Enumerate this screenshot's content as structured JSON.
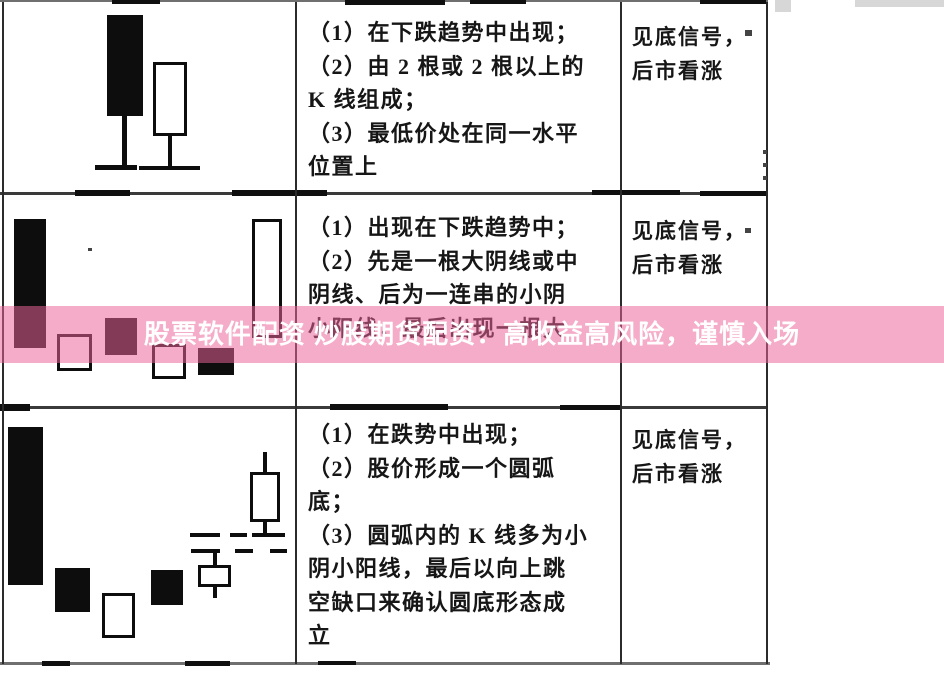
{
  "banner": {
    "text": "股票软件配资 炒股期货配资：高收益高风险，谨慎入场",
    "overlay_color": "#ec6297",
    "text_color": "#ffffff"
  },
  "table": {
    "rows": [
      {
        "description_lines": [
          "（1）在下跌趋势中出现；",
          "（2）由 2 根或 2 根以上的",
          "K 线组成；",
          "（3）最低价处在同一水平",
          "位置上"
        ],
        "signal_lines": [
          "见底信号，",
          "后市看涨"
        ]
      },
      {
        "description_lines": [
          "（1）出现在下跌趋势中；",
          "（2）先是一根大阴线或中",
          "阴线、后为一连串的小阴",
          "小阳线，最后出现一根大"
        ],
        "signal_lines": [
          "见底信号，",
          "后市看涨"
        ]
      },
      {
        "description_lines": [
          "（1）在跌势中出现；",
          "（2）股价形成一个圆弧",
          "底；",
          "（3）圆弧内的 K 线多为小",
          "阴小阳线，最后以向上跳",
          "空缺口来确认圆底形态成",
          "立"
        ],
        "signal_lines": [
          "见底信号，",
          "后市看涨"
        ]
      }
    ]
  }
}
